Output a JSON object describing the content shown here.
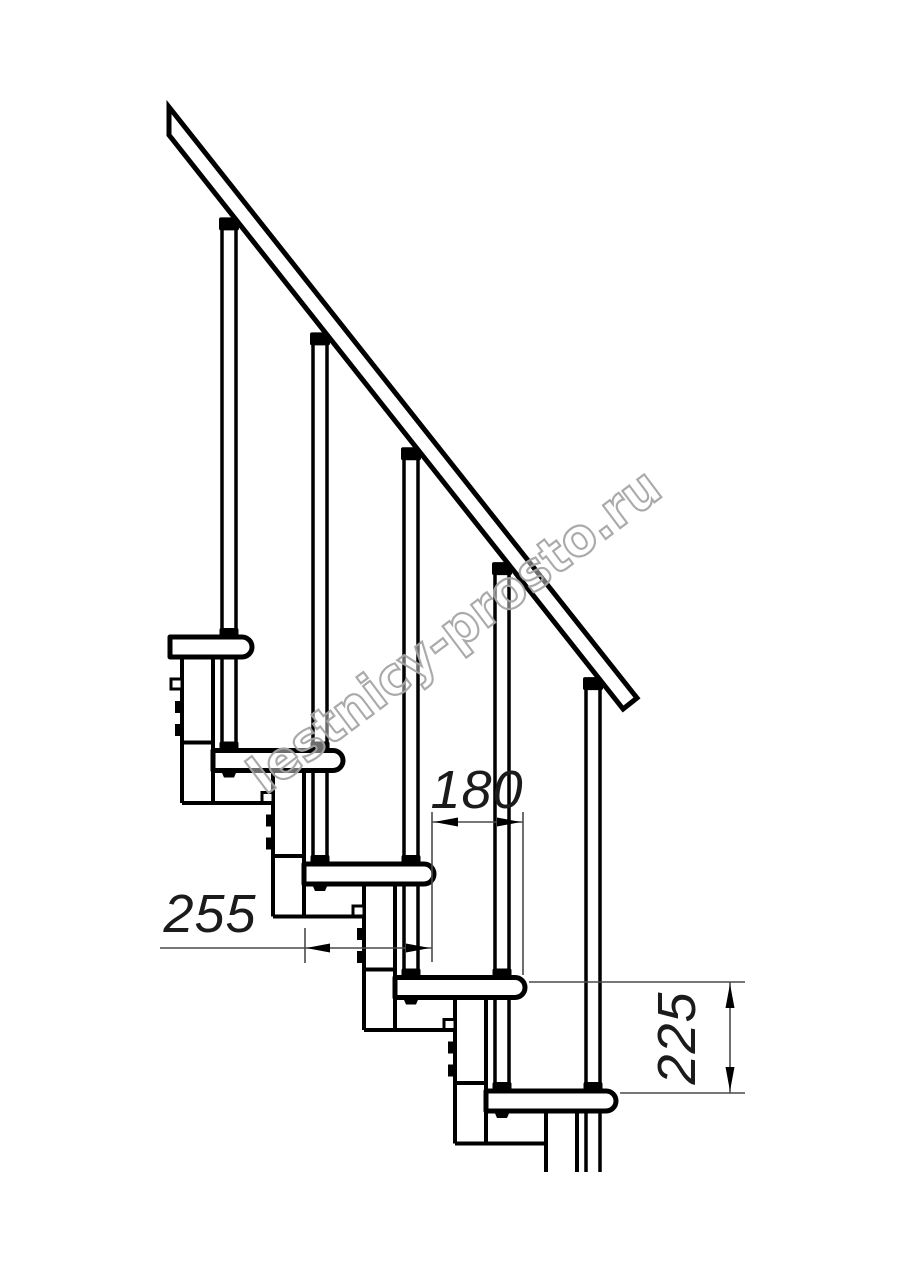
{
  "drawing": {
    "kind": "technical-diagram",
    "subject": "modular staircase side elevation",
    "steps_visible": 5,
    "balusters_visible": 5,
    "line_color": "#000000",
    "thin_line_color": "#4a4a4a",
    "background": "#ffffff"
  },
  "dimensions": {
    "going": {
      "value": "180"
    },
    "tread_depth": {
      "value": "255"
    },
    "rise": {
      "value": "225"
    }
  },
  "watermark": {
    "text": "lestnicy-prosto.ru",
    "color": "#a6a6a6"
  }
}
